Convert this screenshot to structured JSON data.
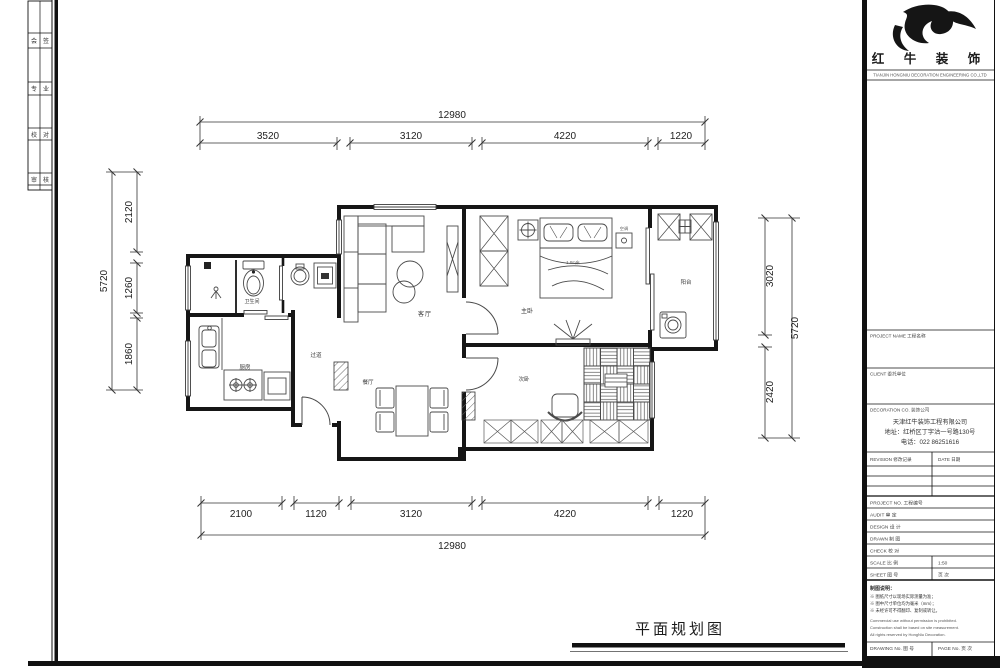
{
  "sheet_title": "平面规划图",
  "frame": {
    "strip": [
      [
        "会",
        "签"
      ],
      [
        "专",
        "业"
      ],
      [
        "校",
        "对"
      ],
      [
        "审",
        "核"
      ]
    ]
  },
  "dims": {
    "top": {
      "total": "12980",
      "segs": [
        "3520",
        "3120",
        "4220",
        "1220"
      ]
    },
    "bottom": {
      "total": "12980",
      "segs": [
        "2100",
        "1120",
        "3120",
        "4220",
        "1220"
      ]
    },
    "left": {
      "total": "5720",
      "segs": [
        "2120",
        "1260",
        "1860"
      ]
    },
    "right": {
      "total": "5720",
      "segs": [
        "3020",
        "2420"
      ]
    }
  },
  "rooms": {
    "living": "客厅",
    "dining": "餐厅",
    "corridor": "过道",
    "kitchen": "厨房",
    "bath": "卫生间",
    "master": "主卧",
    "second": "次卧",
    "balcony": "阳台",
    "ac": "空调",
    "bed_size": "1.8m床"
  },
  "titleblock": {
    "brand": "红 牛 装 饰",
    "brand_sub": "TIANJIN HONGNIU DECORATION ENGINEERING CO.,LTD",
    "section1_label": "PROJECT NAME 工程名称",
    "section2_label": "CLIENT 委托单位",
    "section3_label": "DECORATION CO. 装饰公司",
    "company_lines": [
      "天津红牛装饰工程有限公司",
      "地址：红桥区丁字沽一号路130号",
      "电话：022 86251616"
    ],
    "revision_label": "REVISION 修改记录",
    "date_label": "DATE 日期",
    "small_rows": [
      {
        "l": "PROJECT NO. 工程编号",
        "r": ""
      },
      {
        "l": "AUDIT 审 定",
        "r": ""
      },
      {
        "l": "DESIGN 设 计",
        "r": ""
      },
      {
        "l": "DRAWN 制 图",
        "r": ""
      },
      {
        "l": "CHECK 校 对",
        "r": ""
      },
      {
        "l": "SCALE 比 例",
        "r": "1:50"
      },
      {
        "l": "SHEET 图 号",
        "r": "页 次"
      }
    ],
    "notes_title": "制图说明：",
    "notes_cn": [
      "※ 图纸尺寸以现场实际测量为准；",
      "※ 图中尺寸单位均为毫米（mm）；",
      "※ 未经许可不得翻印、复制或转让。"
    ],
    "notes_en": [
      "Commercial use without permission is prohibited.",
      "Construction shall be based on site measurement.",
      "All rights reserved by HongNiu Decoration."
    ],
    "bottom_left_label": "DRAWING No. 图 号",
    "bottom_right_label": "PAGE No. 页 次"
  }
}
